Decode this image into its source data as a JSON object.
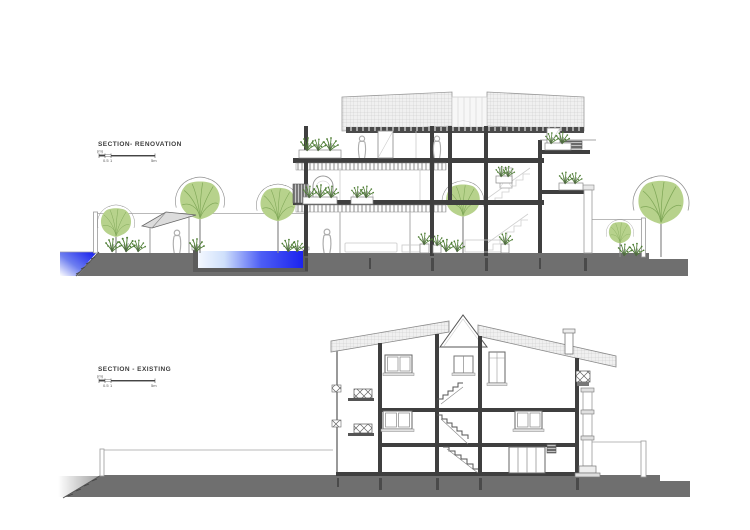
{
  "page": {
    "background": "#ffffff",
    "description": "Architectural drawing sheet with two building sections"
  },
  "figures": {
    "renovation": {
      "title": "SECTION- RENOVATION"
    },
    "existing": {
      "title": "SECTION - EXISTING"
    }
  },
  "scale_bar": {
    "unit": "(m)",
    "tick_half": "0.5",
    "tick_one": "1",
    "tick_five": "5m"
  },
  "colors": {
    "ground": "#6f6f6f",
    "line_dark": "#3f3f3f",
    "line_mid": "#8a8a8a",
    "line_light": "#c8c8c8",
    "pool_deep": "#1b23ee",
    "pool_mid": "#4d5ef5",
    "pool_light": "#eef3ff",
    "tree_fill": "#b7d28c",
    "tree_vein": "#7fa757",
    "tree_outline": "#8f8f8f",
    "plant": "#4e7d34",
    "roof_fill": "#f0f0f0",
    "roof_hatch": "#c6c6c6",
    "wall_white": "#ffffff"
  }
}
